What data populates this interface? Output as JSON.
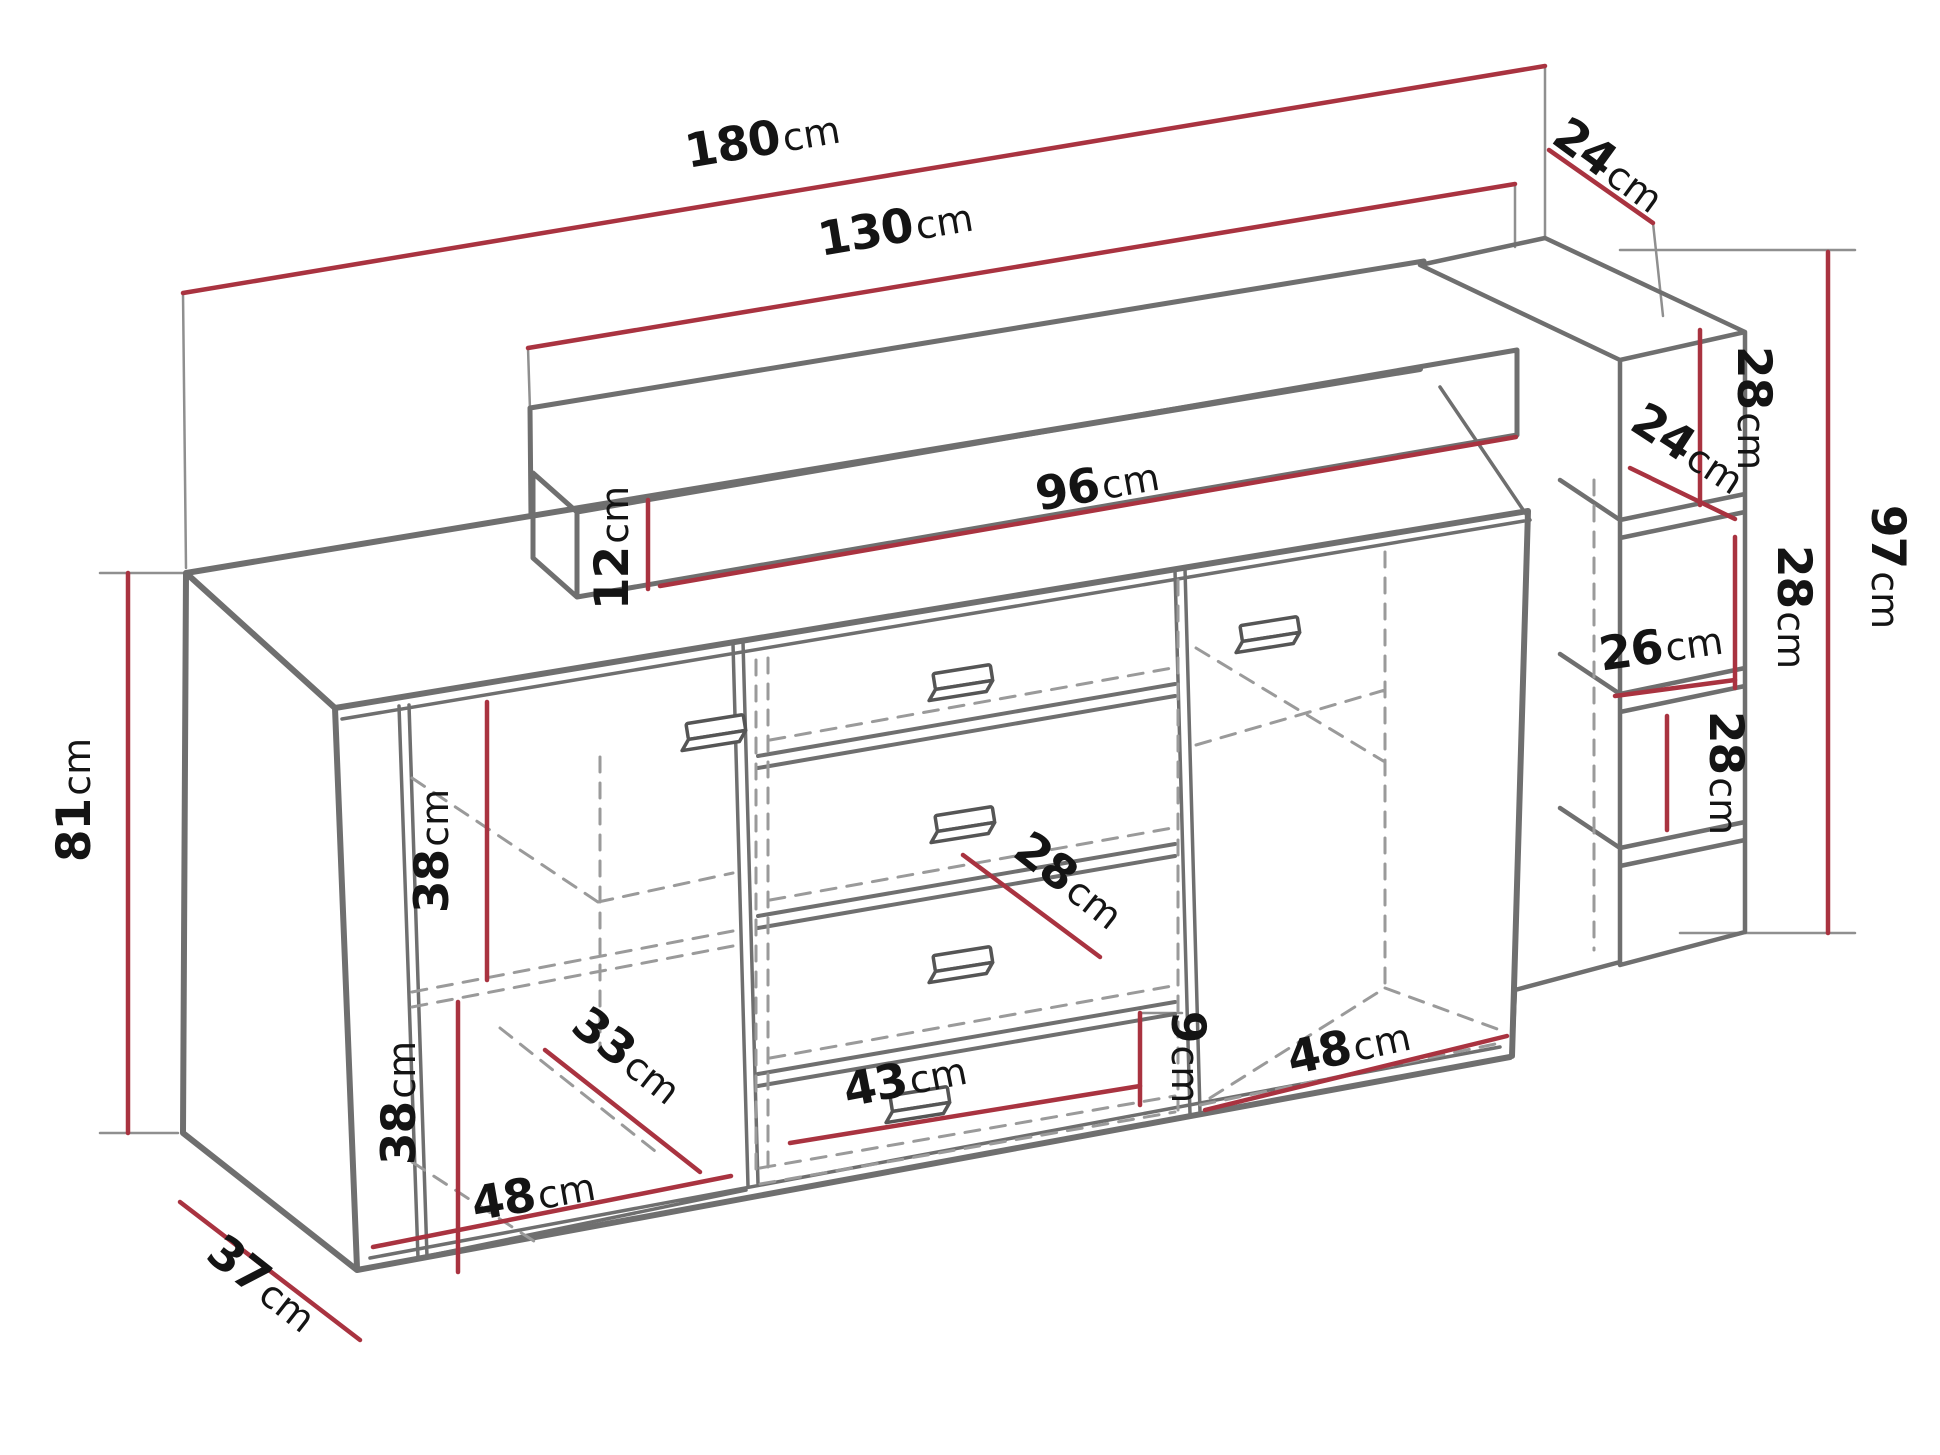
{
  "diagram": {
    "kind": "furniture-dimension-drawing",
    "subject": "sideboard with back panel, floating shelf and right shelf column",
    "unit": "cm",
    "colors": {
      "dimension_line": "#a93340",
      "structure_line": "#6f6f6f",
      "hidden_line": "#9a9a9a",
      "label_text": "#141414",
      "background": "#ffffff"
    },
    "dimensions": {
      "total_width": {
        "value": "180",
        "unit": "cm"
      },
      "back_panel_width": {
        "value": "130",
        "unit": "cm"
      },
      "top_depth": {
        "value": "24",
        "unit": "cm"
      },
      "shelf_length": {
        "value": "96",
        "unit": "cm"
      },
      "shelf_height": {
        "value": "12",
        "unit": "cm"
      },
      "right_top_section_height": {
        "value": "28",
        "unit": "cm"
      },
      "right_column_depth": {
        "value": "24",
        "unit": "cm"
      },
      "right_middle_section_height": {
        "value": "28",
        "unit": "cm"
      },
      "right_column_height": {
        "value": "97",
        "unit": "cm"
      },
      "right_opening_width": {
        "value": "26",
        "unit": "cm"
      },
      "right_bottom_section_height": {
        "value": "28",
        "unit": "cm"
      },
      "body_height": {
        "value": "81",
        "unit": "cm"
      },
      "left_upper_section_height": {
        "value": "38",
        "unit": "cm"
      },
      "left_lower_section_height": {
        "value": "38",
        "unit": "cm"
      },
      "left_door_width": {
        "value": "48",
        "unit": "cm"
      },
      "interior_depth": {
        "value": "33",
        "unit": "cm"
      },
      "body_depth": {
        "value": "37",
        "unit": "cm"
      },
      "drawer_depth": {
        "value": "28",
        "unit": "cm"
      },
      "drawer_front_height": {
        "value": "9",
        "unit": "cm"
      },
      "drawer_width": {
        "value": "43",
        "unit": "cm"
      },
      "right_door_width": {
        "value": "48",
        "unit": "cm"
      }
    }
  }
}
